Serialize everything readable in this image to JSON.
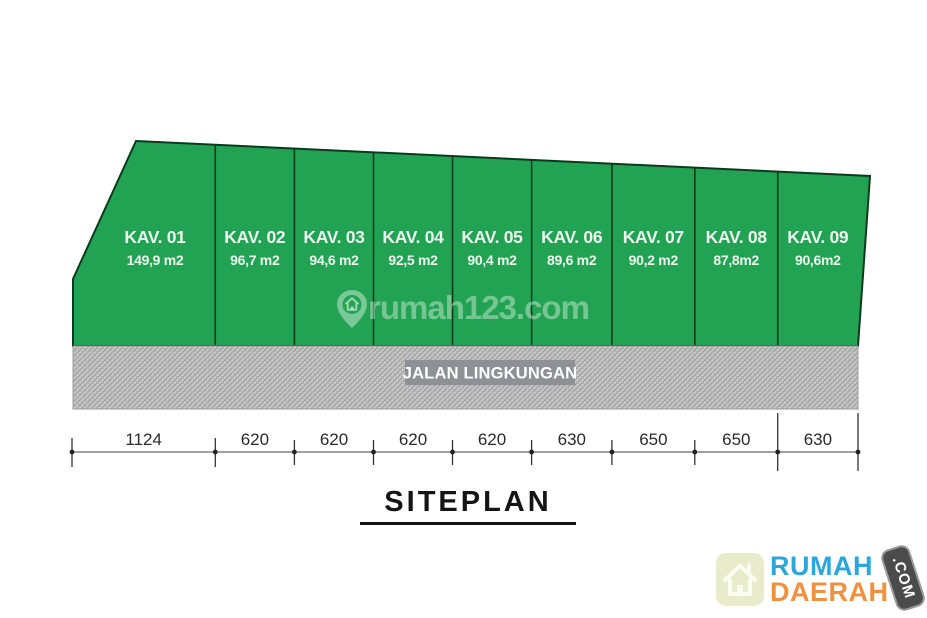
{
  "title": "SITEPLAN",
  "plots": [
    {
      "name": "KAV. 01",
      "area": "149,9 m2"
    },
    {
      "name": "KAV. 02",
      "area": "96,7 m2"
    },
    {
      "name": "KAV. 03",
      "area": "94,6 m2"
    },
    {
      "name": "KAV. 04",
      "area": "92,5 m2"
    },
    {
      "name": "KAV. 05",
      "area": "90,4 m2"
    },
    {
      "name": "KAV. 06",
      "area": "89,6 m2"
    },
    {
      "name": "KAV. 07",
      "area": "90,2 m2"
    },
    {
      "name": "KAV. 08",
      "area": "87,8m2"
    },
    {
      "name": "KAV. 09",
      "area": "90,6m2"
    }
  ],
  "road": {
    "label": "JALAN LINGKUNGAN"
  },
  "dimensions": [
    "1124",
    "620",
    "620",
    "620",
    "620",
    "630",
    "650",
    "650",
    "630"
  ],
  "watermark": {
    "text": "rumah123.com",
    "icon": "location-pin-house-icon"
  },
  "logo": {
    "line1": "RUMAH",
    "line2": "DAERAH",
    "badge": ".COM",
    "icon": "home-icon"
  },
  "colors": {
    "plot_green": "#22a353",
    "plot_border": "#0a3b1d",
    "road_gray": "#c9c9c9",
    "road_hatch": "#969696",
    "road_label_bg": "#8d9196",
    "brand_blue": "#2ba7dc",
    "brand_orange": "#f0913f",
    "badge_gray": "#4b4b4b"
  }
}
